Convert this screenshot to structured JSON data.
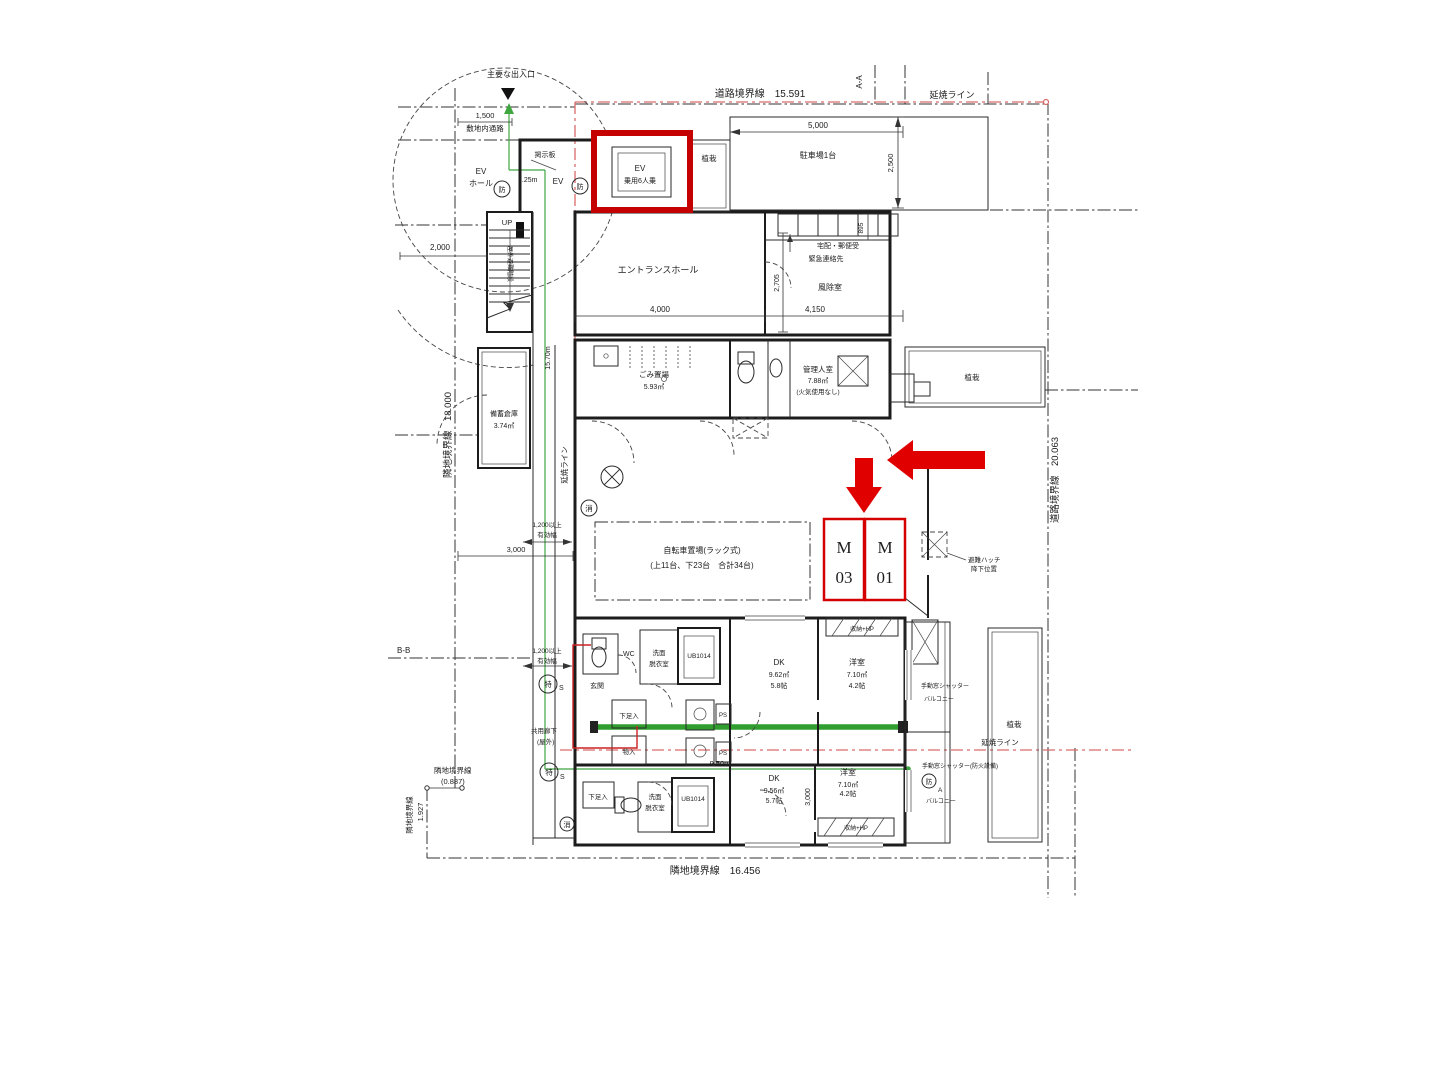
{
  "colors": {
    "annotation_red": "#d40000",
    "ensho_red": "#d96a6a",
    "path_green": "#3fa53f",
    "ink": "#1c1c1c"
  },
  "boundaries": {
    "road_top": "道路境界線　15.591",
    "road_right": "道路境界線　20.063",
    "neighbor_left": "隣地境界線　18.000",
    "neighbor_bottom": "隣地境界線　16.456",
    "neighbor_corner_name": "隣地境界線",
    "neighbor_corner_value": "(0.887)",
    "neighbor_corner2_name": "隣地境界線",
    "neighbor_corner2_value": "1.927",
    "ensho_line": "延焼ライン",
    "section_aa": "A-A",
    "section_bb": "B-B"
  },
  "dims": {
    "d1500": "1,500",
    "d2000": "2,000",
    "d2500": "2,500",
    "d5000": "5,000",
    "d4000": "4,000",
    "d4150": "4,150",
    "d2705": "2,705",
    "d895": "895",
    "d3000": "3,000",
    "d9_50": "9.50m",
    "d15_70": "15.70m",
    "d1_25": "1.25m",
    "w1200_l1": "1,200以上",
    "w1200_l2": "有効幅"
  },
  "site": {
    "main_entry": "主要な出入口",
    "site_path": "敷地内通路",
    "bulletin": "掲示板",
    "planting": "植栽",
    "parking": "駐車場1台",
    "up": "UP",
    "outdoor_stairs": "屋外避難階段"
  },
  "ev": {
    "hall_l1": "EV",
    "hall_l2": "ホール",
    "tag": "EV",
    "car_l1": "EV",
    "car_l2": "乗用6人乗"
  },
  "lobby": {
    "entrance_hall": "エントランスホール",
    "mailbox": "宅配・郵便受",
    "emergency": "緊急連絡先",
    "windbreak": "風除室"
  },
  "rooms": {
    "garbage_name": "ごみ置場",
    "garbage_area": "5.93㎡",
    "manager_name": "管理人室",
    "manager_area": "7.88㎡",
    "manager_note": "(火気使用なし)",
    "stock_name": "備蓄倉庫",
    "stock_area": "3.74㎡",
    "bike_l1": "自転車置場(ラック式)",
    "bike_l2": "(上11台、下23台　合計34台)"
  },
  "m_units": {
    "m03_letter": "M",
    "m03_number": "03",
    "m01_letter": "M",
    "m01_number": "01"
  },
  "hatch": {
    "l1": "避難ハッチ",
    "l2": "降下位置"
  },
  "unit_a": {
    "dk": "DK",
    "dk_area": "9.62㎡",
    "dk_size": "5.8帖",
    "bed": "洋室",
    "bed_area": "7.10㎡",
    "bed_size": "4.2帖"
  },
  "unit_b": {
    "dk": "DK",
    "dk_area": "9.56㎡",
    "dk_size": "5.7帖",
    "bed": "洋室",
    "bed_area": "7.10㎡",
    "bed_size": "4.2帖"
  },
  "fixtures": {
    "wc": "WC",
    "wash_l1": "洗面",
    "wash_l2": "脱衣室",
    "ub": "UB1014",
    "entrance": "玄関",
    "shoe": "下足入",
    "storage": "物入",
    "ps": "PS",
    "closet": "収納+HP"
  },
  "corridor": {
    "l1": "共用廊下",
    "l2": "(屋外)"
  },
  "shutter": {
    "manual": "手動窓シャッター",
    "manual_fire": "手動窓シャッター(防火設備)",
    "balcony": "バルコニー"
  },
  "marks": {
    "fire": "防",
    "ext": "消",
    "special": "特",
    "s": "S",
    "a": "A"
  }
}
